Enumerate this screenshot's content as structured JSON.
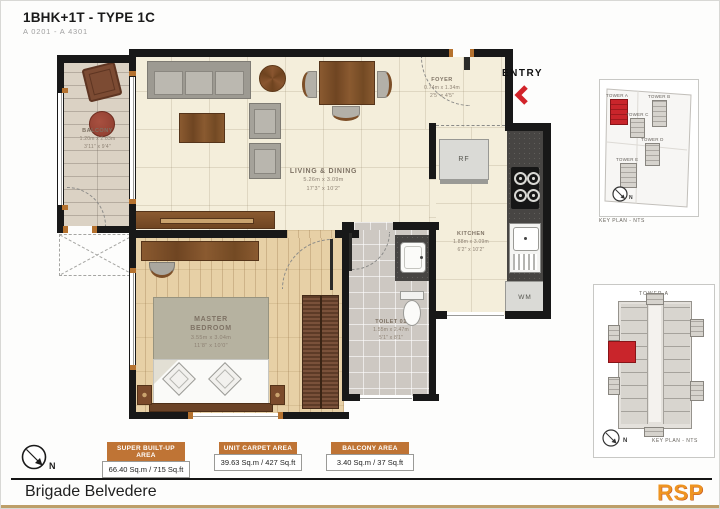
{
  "header": {
    "title": "1BHK+1T - TYPE 1C",
    "subtitle": "A 0201 - A 4301"
  },
  "entry_label": "ENTRY",
  "rooms": {
    "balcony": {
      "name": "BALCONY",
      "dim_m": "1.20m x 2.83m",
      "dim_ft": "3'11\" x 9'4\""
    },
    "living": {
      "name": "LIVING & DINING",
      "dim_m": "5.26m x 3.09m",
      "dim_ft": "17'3\" x 10'2\""
    },
    "foyer": {
      "name": "FOYER",
      "dim_m": "0.74m x 1.34m",
      "dim_ft": "2'5\" x 4'5\""
    },
    "kitchen": {
      "name": "KITCHEN",
      "dim_m": "1.88m x 3.09m",
      "dim_ft": "6'2\" x 10'2\""
    },
    "master_bedroom": {
      "name": "MASTER BEDROOM",
      "dim_m": "3.55m x 3.04m",
      "dim_ft": "11'8\" x 10'0\""
    },
    "toilet": {
      "name": "TOILET 01",
      "dim_m": "1.55m x 2.47m",
      "dim_ft": "5'1\" x 8'1\""
    }
  },
  "appliances": {
    "fridge": "RF",
    "washing_machine": "WM"
  },
  "key_plan_site": {
    "towers": [
      "TOWER A",
      "TOWER B",
      "TOWER C",
      "TOWER D",
      "TOWER E"
    ],
    "highlighted_tower": "TOWER A",
    "caption": "KEY PLAN - NTS",
    "north": "N"
  },
  "key_plan_tower": {
    "title": "TOWER A",
    "caption": "KEY PLAN - NTS",
    "north": "N"
  },
  "area_summary": [
    {
      "label": "SUPER BUILT-UP AREA",
      "value": "66.40 Sq.m / 715 Sq.ft"
    },
    {
      "label": "UNIT CARPET AREA",
      "value": "39.63 Sq.m / 427 Sq.ft"
    },
    {
      "label": "BALCONY AREA",
      "value": "3.40 Sq.m / 37 Sq.ft"
    }
  ],
  "compass": {
    "north": "N"
  },
  "footer": {
    "project_name": "Brigade Belvedere",
    "logo": "RSP"
  },
  "colors": {
    "wall": "#181818",
    "accent_orange": "#bf7435",
    "highlight_red": "#c9252b",
    "logo_orange": "#ee9421",
    "gold_strip": "#bd9f69",
    "entry_red": "#d2232a"
  }
}
